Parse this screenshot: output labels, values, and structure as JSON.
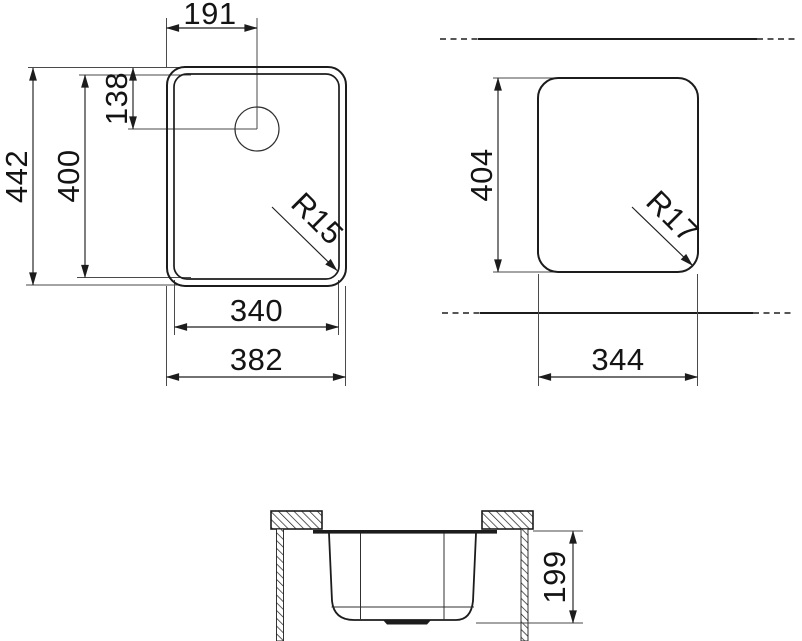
{
  "drawing": {
    "background": "#ffffff",
    "line_color": "#1c1c1c",
    "top_view": {
      "label_drain_offset_x": "191",
      "label_drain_offset_y": "138",
      "label_overall_height": "442",
      "label_bowl_height": "400",
      "label_bowl_width": "340",
      "label_overall_width": "382",
      "label_corner_radius": "R15"
    },
    "cutout_view": {
      "label_cutout_height": "404",
      "label_cutout_width": "344",
      "label_corner_radius": "R17"
    },
    "section_view": {
      "label_bowl_depth": "199"
    }
  }
}
